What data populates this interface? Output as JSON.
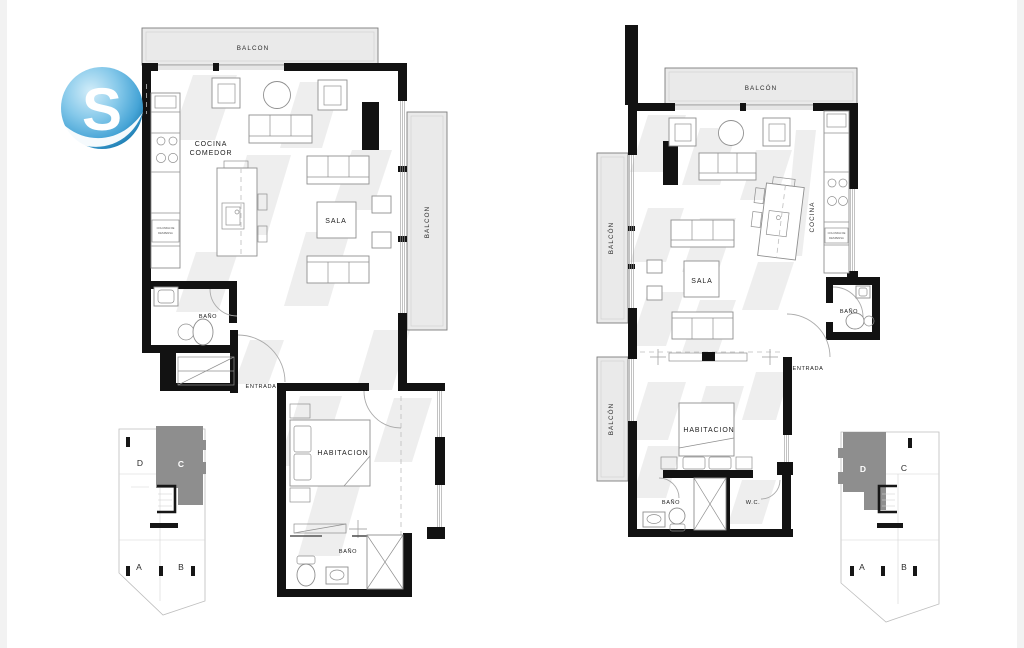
{
  "logo": {
    "letter": "S",
    "color": "#5db4e0"
  },
  "colors": {
    "wall": "#121212",
    "balcony_fill": "#eaeaea",
    "shadow": "#e3e3e3",
    "highlight_unit": "#8e8e8e",
    "logo_blue": "#5db4e0"
  },
  "left_plan": {
    "name": "unit-c-floor-plan",
    "labels": {
      "balcon_top": "BALCON",
      "balcon_right": "BALCON",
      "cocina_line1": "COCINA",
      "cocina_line2": "COMEDOR",
      "sala": "SALA",
      "bano_upper": "BAÑO",
      "entrada": "ENTRADA",
      "habitacion": "HABITACION",
      "bano_lower": "BAÑO",
      "columna_line1": "COLUMNA DE",
      "columna_line2": "DESPENSA"
    },
    "keyplan": {
      "highlighted": "C",
      "units": [
        {
          "label": "D"
        },
        {
          "label": "C"
        },
        {
          "label": "A"
        },
        {
          "label": "B"
        }
      ]
    }
  },
  "right_plan": {
    "name": "unit-d-floor-plan",
    "labels": {
      "balcon_top": "BALCÓN",
      "balcon_left_upper": "BALCÓN",
      "balcon_left_lower": "BALCÓN",
      "cocina": "COCINA",
      "sala": "SALA",
      "bano_upper": "BAÑO",
      "entrada": "ENTRADA",
      "habitacion": "HABITACION",
      "bano_lower": "BAÑO",
      "wc": "W.C.",
      "columna_line1": "COLUMNA DE",
      "columna_line2": "DESPENSA"
    },
    "keyplan": {
      "highlighted": "D",
      "units": [
        {
          "label": "D"
        },
        {
          "label": "C"
        },
        {
          "label": "A"
        },
        {
          "label": "B"
        }
      ]
    }
  }
}
